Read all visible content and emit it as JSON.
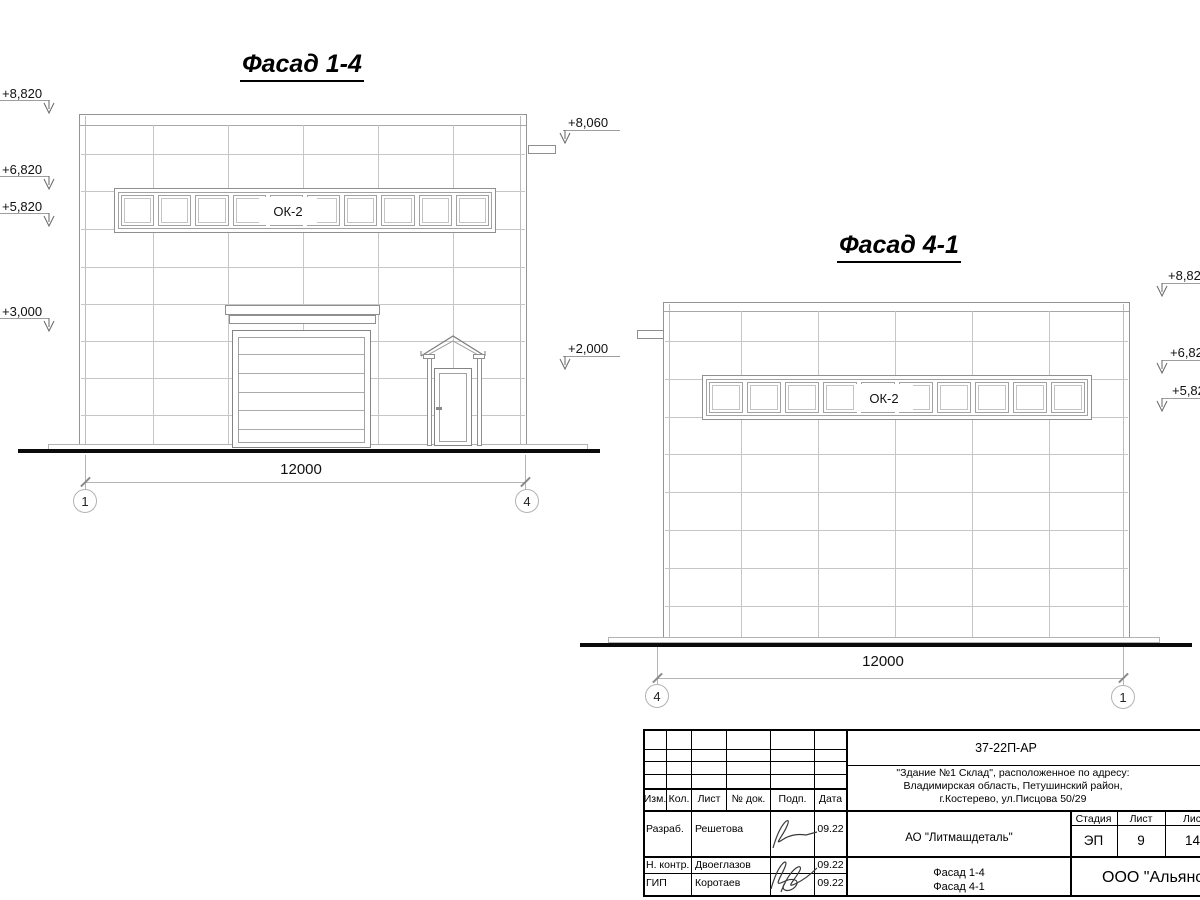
{
  "sheet": {
    "facade_1_4": {
      "title": "Фасад 1-4",
      "window_label": "ОК-2",
      "dimension": "12000",
      "axis_left": "1",
      "axis_right": "4",
      "elev_left": [
        "+8,820",
        "+6,820",
        "+5,820",
        "+3,000"
      ],
      "elev_right": [
        "+8,060",
        "+2,000"
      ]
    },
    "facade_4_1": {
      "title": "Фасад 4-1",
      "window_label": "ОК-2",
      "dimension": "12000",
      "axis_left": "4",
      "axis_right": "1",
      "elev_right": [
        "+8,820",
        "+6,820",
        "+5,820"
      ]
    },
    "title_block": {
      "doc_number": "37-22П-АР",
      "address_line1": "\"Здание №1 Склад\", расположенное по адресу:",
      "address_line2": "Владимирская область, Петушинский район,",
      "address_line3": "г.Костерево, ул.Писцова 50/29",
      "organization": "АО \"Литмашдеталь\"",
      "sheet_name_line1": "Фасад 1-4",
      "sheet_name_line2": "Фасад 4-1",
      "company": "ООО \"Альянс\"",
      "columns": [
        "Изм.",
        "Кол.",
        "Лист",
        "№ док.",
        "Подп.",
        "Дата"
      ],
      "stage_label": "Стадия",
      "sheet_label": "Лист",
      "sheets_label": "Листов",
      "stage_value": "ЭП",
      "sheet_value": "9",
      "sheets_value": "14",
      "rows": [
        {
          "role": "Разраб.",
          "name": "Решетова",
          "date": "09.22"
        },
        {
          "role": "Н. контр.",
          "name": "Двоеглазов",
          "date": "09.22"
        },
        {
          "role": "ГИП",
          "name": "Коротаев",
          "date": "09.22"
        }
      ]
    }
  }
}
